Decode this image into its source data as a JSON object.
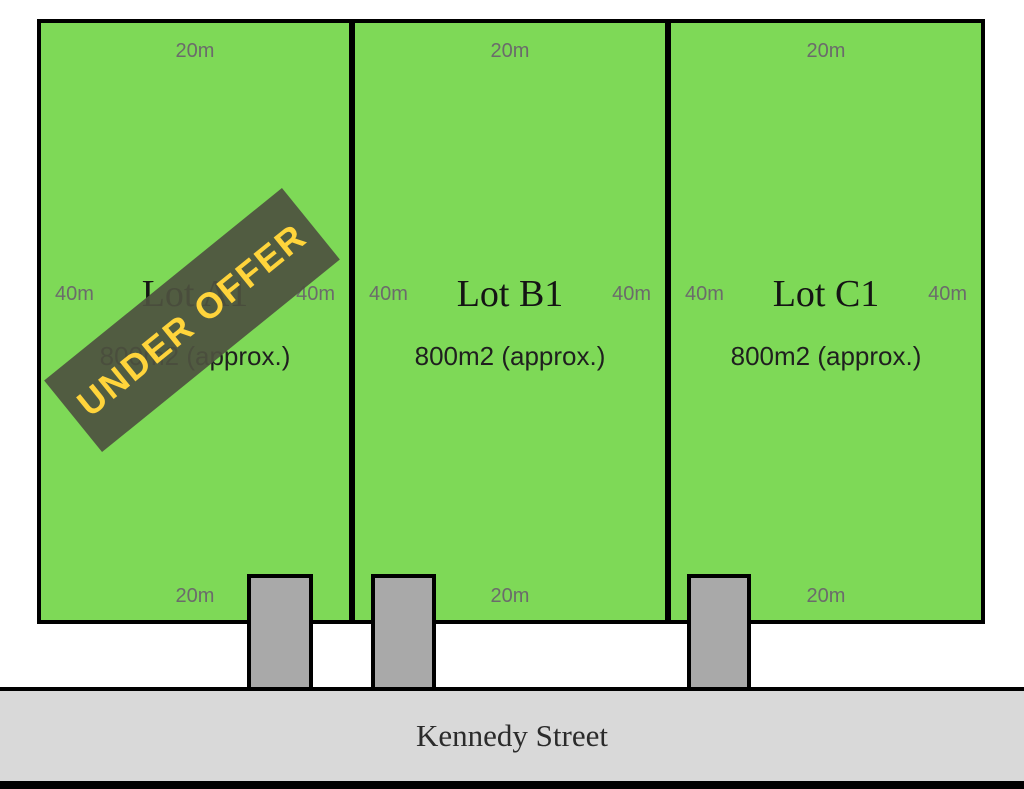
{
  "plan": {
    "title": "Land subdivision plan",
    "street": {
      "name": "Kennedy Street"
    },
    "lots": [
      {
        "name": "Lot A1",
        "area": "800m2 (approx.)",
        "frontage_top": "20m",
        "frontage_bottom": "20m",
        "depth_left": "40m",
        "depth_right": "40m",
        "status_banner": "UNDER OFFER"
      },
      {
        "name": "Lot B1",
        "area": "800m2 (approx.)",
        "frontage_top": "20m",
        "frontage_bottom": "20m",
        "depth_left": "40m",
        "depth_right": "40m"
      },
      {
        "name": "Lot C1",
        "area": "800m2 (approx.)",
        "frontage_top": "20m",
        "frontage_bottom": "20m",
        "depth_left": "40m",
        "depth_right": "40m"
      }
    ],
    "colors": {
      "lot_fill": "#7ED957",
      "outline": "#000000",
      "driveway_fill": "#A9A9A9",
      "street_fill": "#D9D9D9",
      "banner_fill": "#4D523F",
      "banner_text": "#FFD43B",
      "dimension_text": "#6B6B6B"
    }
  }
}
